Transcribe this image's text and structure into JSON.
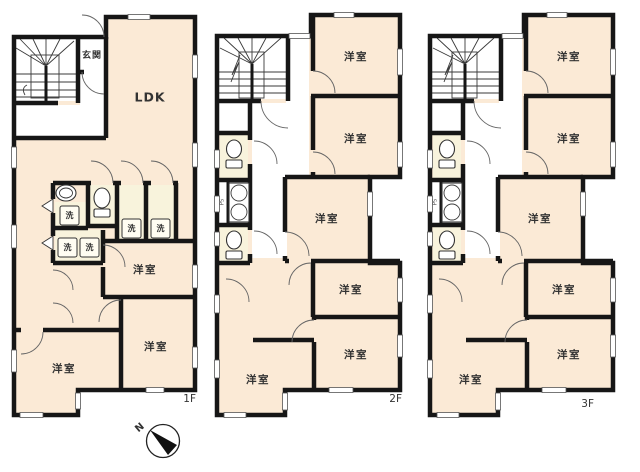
{
  "colors": {
    "wall": "#161616",
    "room_fill": "#fbead6",
    "wet_area_fill": "#f8f3dc",
    "fixture_fill": "#ffffff",
    "background": "#ffffff",
    "text": "#333333"
  },
  "floors": [
    {
      "floor_label": "1F",
      "entrance_label": "玄関",
      "living_label": "LDK",
      "wash_labels": [
        "洗",
        "洗",
        "洗",
        "洗",
        "洗"
      ],
      "room_labels": [
        "洋室",
        "洋室",
        "洋室"
      ]
    },
    {
      "floor_label": "2F",
      "pipe_space_label": "PS",
      "room_labels": [
        "洋室",
        "洋室",
        "洋室",
        "洋室",
        "洋室",
        "洋室"
      ]
    },
    {
      "floor_label": "3F",
      "pipe_space_label": "PS",
      "room_labels": [
        "洋室",
        "洋室",
        "洋室",
        "洋室",
        "洋室",
        "洋室"
      ]
    }
  ],
  "compass": {
    "north_label": "N"
  }
}
